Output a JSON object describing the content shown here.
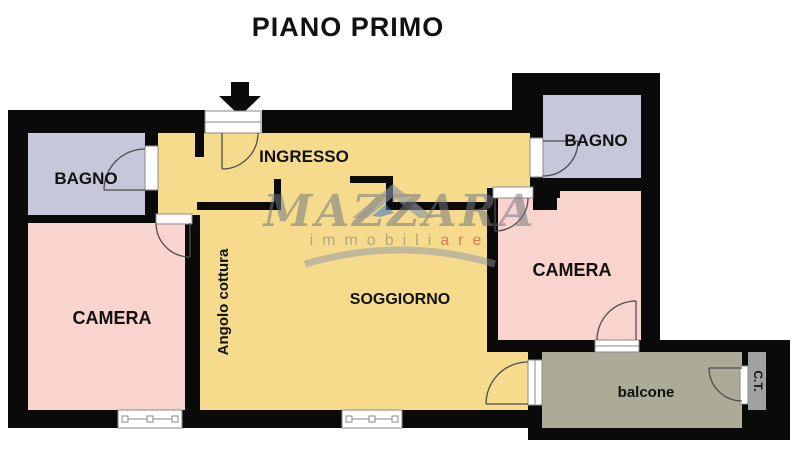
{
  "title": "PIANO PRIMO",
  "rooms": {
    "bagno_left": "BAGNO",
    "bagno_right": "BAGNO",
    "ingresso": "INGRESSO",
    "camera_left": "CAMERA",
    "camera_right": "CAMERA",
    "soggiorno": "SOGGIORNO",
    "angolo_cottura": "Angolo cottura",
    "balcone": "balcone",
    "ct": "C.T."
  },
  "watermark": {
    "name": "MAZZARA",
    "subtitle_gray": "immobili",
    "subtitle_red": "are"
  },
  "icons": {
    "entrance": "entrance-arrow-down",
    "watermark_house": "house-roof"
  },
  "colors": {
    "background": "#ffffff",
    "wall": "#0a0a0a",
    "living": "#f6db8d",
    "bedroom": "#f9d3cd",
    "bathroom": "#c7c7dc",
    "balcony": "#abab97",
    "ct_room": "#a2a2a2",
    "label": "#111111",
    "door_arc": "#4d4d4d",
    "frame_edge": "#8a8a8a",
    "watermark_gray": "#6f7680",
    "watermark_sub": "#7d8279",
    "watermark_red": "#c0392b",
    "watermark_roof": "#8b95a8",
    "watermark_blue": "#3b74c4"
  }
}
